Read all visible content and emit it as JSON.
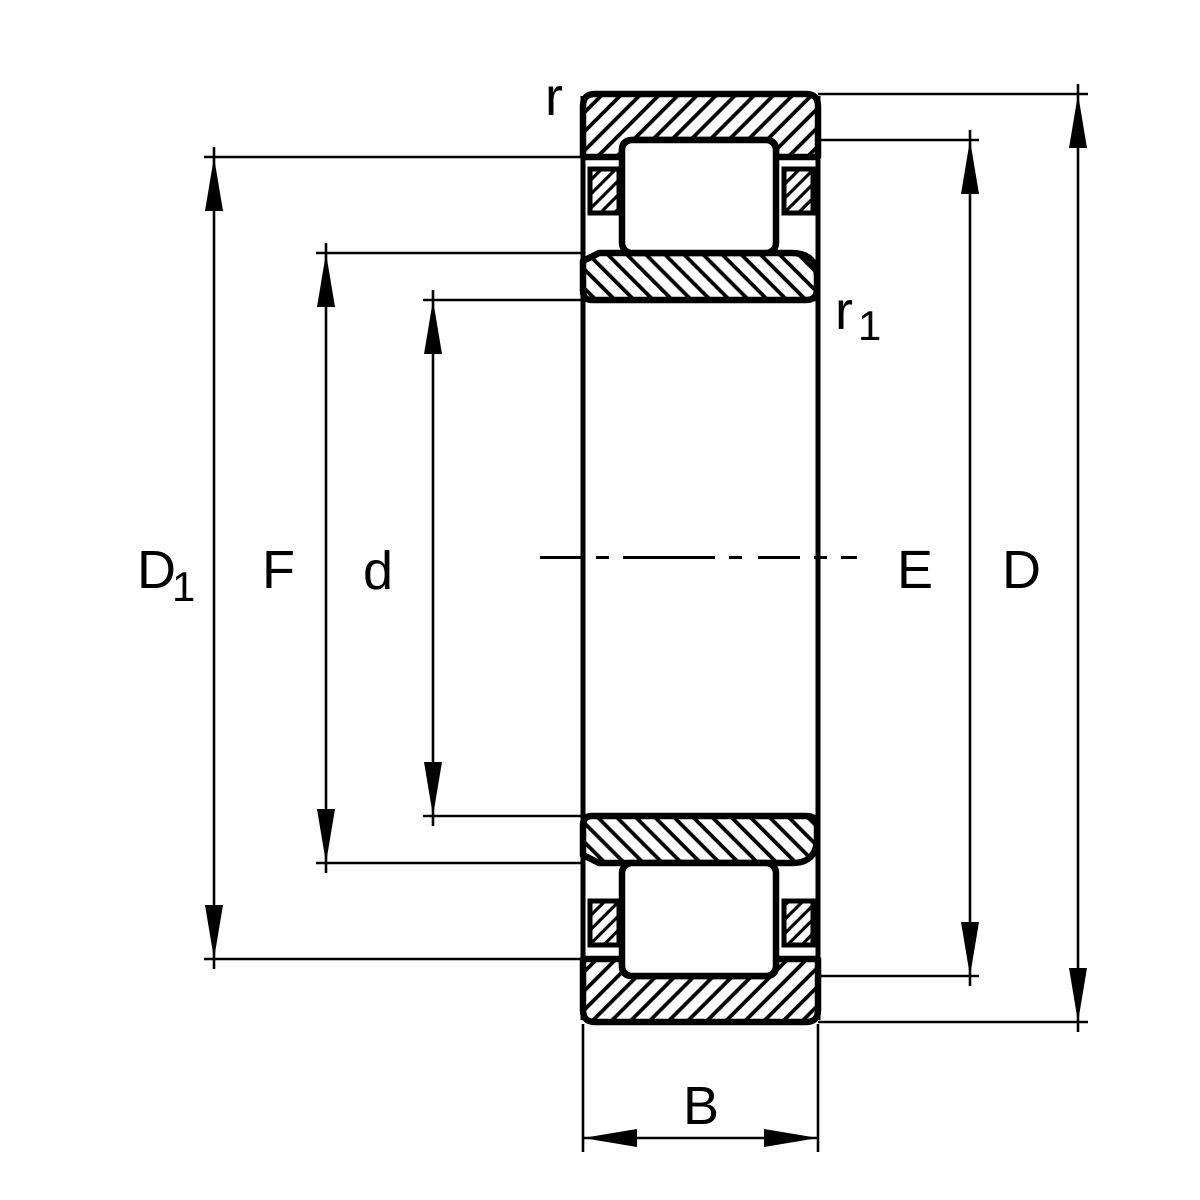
{
  "drawing": {
    "kind": "bearing-cross-section",
    "colors": {
      "ink": "#000000",
      "background": "#ffffff"
    },
    "labels": {
      "r": {
        "base": "r"
      },
      "r1": {
        "base": "r",
        "sub": "1"
      },
      "D1": {
        "base": "D",
        "sub": "1"
      },
      "F": {
        "base": "F"
      },
      "d": {
        "base": "d"
      },
      "E": {
        "base": "E"
      },
      "D": {
        "base": "D"
      },
      "B": {
        "base": "B"
      }
    }
  }
}
